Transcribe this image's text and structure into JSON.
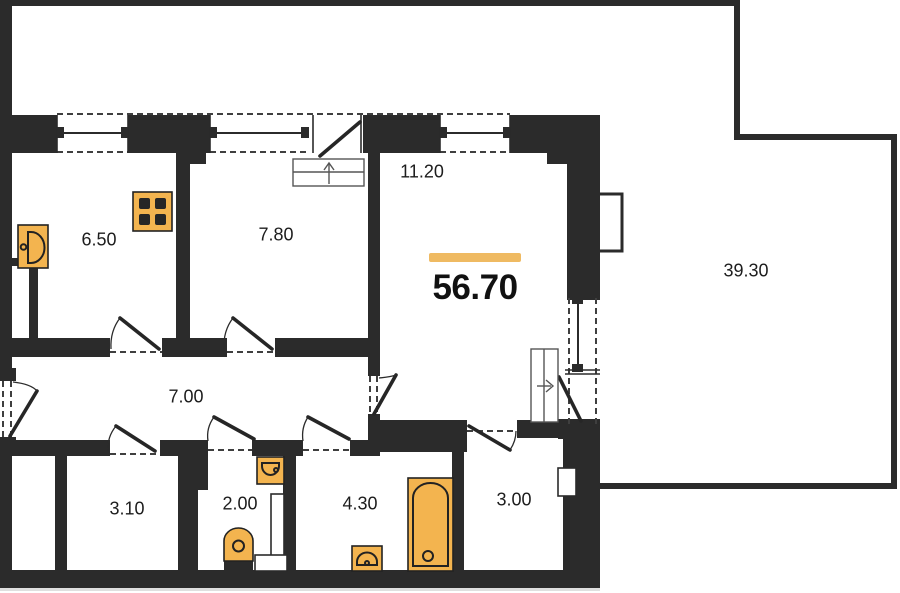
{
  "title": "Apartment floor plan",
  "total": {
    "area": "56.70"
  },
  "rooms": [
    {
      "id": "kitchen",
      "area": "6.50"
    },
    {
      "id": "bedroom",
      "area": "7.80"
    },
    {
      "id": "living-room",
      "area": "11.20"
    },
    {
      "id": "hallway",
      "area": "7.00"
    },
    {
      "id": "storage",
      "area": "3.10"
    },
    {
      "id": "wc",
      "area": "2.00"
    },
    {
      "id": "bathroom",
      "area": "4.30"
    },
    {
      "id": "small-room",
      "area": "3.00"
    },
    {
      "id": "terrace",
      "area": "39.30"
    }
  ],
  "fixtures": [
    {
      "name": "kitchen-sink-icon",
      "room": "kitchen"
    },
    {
      "name": "stove-icon",
      "room": "kitchen"
    },
    {
      "name": "toilet-icon",
      "room": "wc"
    },
    {
      "name": "water-heater-icon",
      "room": "wc"
    },
    {
      "name": "washbasin-icon",
      "room": "bathroom"
    },
    {
      "name": "bathtub-icon",
      "room": "bathroom"
    }
  ],
  "symbols": [
    {
      "name": "entry-steps-up-arrow"
    },
    {
      "name": "terrace-steps-right-arrow"
    },
    {
      "name": "radiator"
    }
  ],
  "colors": {
    "wall": "#2b2b2b",
    "line": "#2b2b2b",
    "fixture_fill": "#f3b44f",
    "accent_bar": "#efba62",
    "text": "#1d1d1d"
  }
}
